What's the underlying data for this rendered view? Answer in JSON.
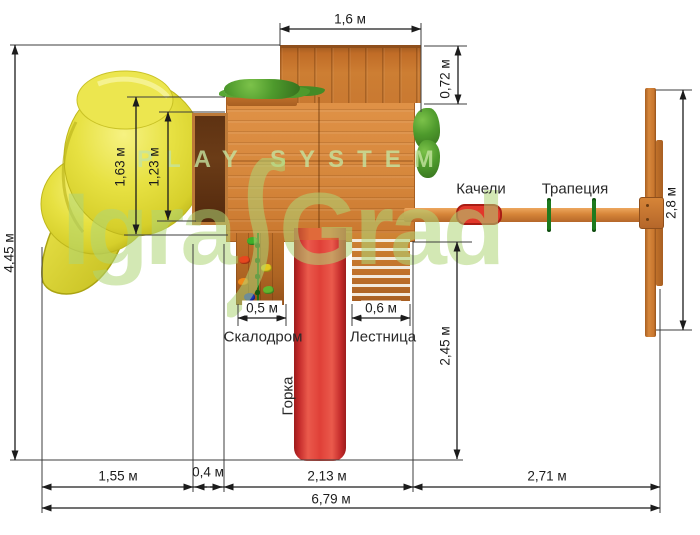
{
  "diagram": {
    "items": {
      "swing": "Качели",
      "trapeze": "Трапеция",
      "climbing_wall": "Скалодром",
      "ladder": "Лестница",
      "slide": "Горка"
    },
    "dims": {
      "roof_width": "1,6 м",
      "roof_depth": "0,72 м",
      "total_depth": "4,45 м",
      "tube_slide_outer": "1,63 м",
      "tube_slide_inner": "1,23 м",
      "crossbar_length": "2,8 м",
      "swing_zone_depth": "2,45 м",
      "climbing_wall_width": "0,5 м",
      "ladder_width": "0,6 м",
      "tube_zone_width": "1,55 м",
      "balcony_width": "0,4 м",
      "deck_width": "2,13 м",
      "swing_section_width": "2,71 м",
      "total_width": "6,79 м"
    },
    "watermark": {
      "subtitle": "PLAY SYSTEM",
      "brand_left": "Igra",
      "brand_right": "Grad"
    },
    "colors": {
      "wood": "#cd7f35",
      "wood_dark": "#5c3514",
      "slide_red": "#d83232",
      "tube_yellow": "#e3dc35",
      "foliage_green": "#4e9a2c",
      "watermark_green": "#aed676",
      "dimension_line": "#1c1c1c"
    }
  }
}
